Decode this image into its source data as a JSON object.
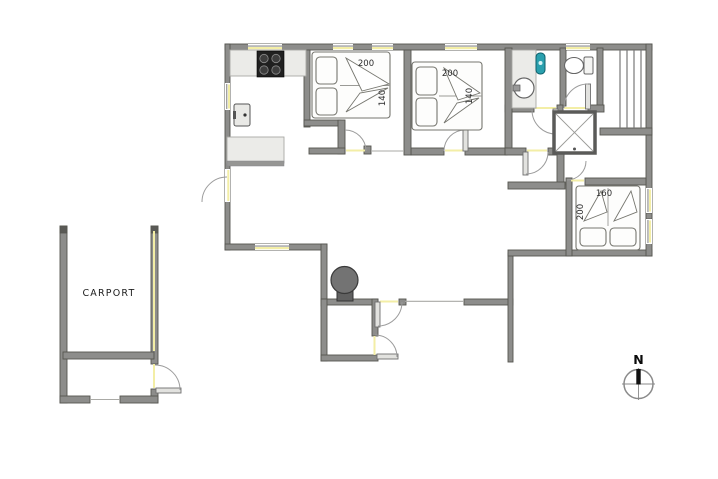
{
  "floorplan": {
    "carport": {
      "label": "CARPORT"
    },
    "compass": {
      "label": "N"
    },
    "bedroom1": {
      "bed_length": "200",
      "bed_width": "140"
    },
    "bedroom2": {
      "bed_length": "200",
      "bed_width": "140"
    },
    "bedroom3": {
      "bed_width": "160",
      "bed_length": "200"
    },
    "colors": {
      "wall": "#8d8d8b",
      "wall_edge": "#55554f",
      "opening": "#f3eea6",
      "arc": "#9c9c9c",
      "counter": "#ebebe8",
      "counter_edge": "#a9a9a5",
      "stove_top": "#202020",
      "wood_stove": "#737373",
      "accent_teal": "#2aa0ae",
      "leaf": "#e2e2df",
      "label": "#2d2d2d"
    }
  }
}
